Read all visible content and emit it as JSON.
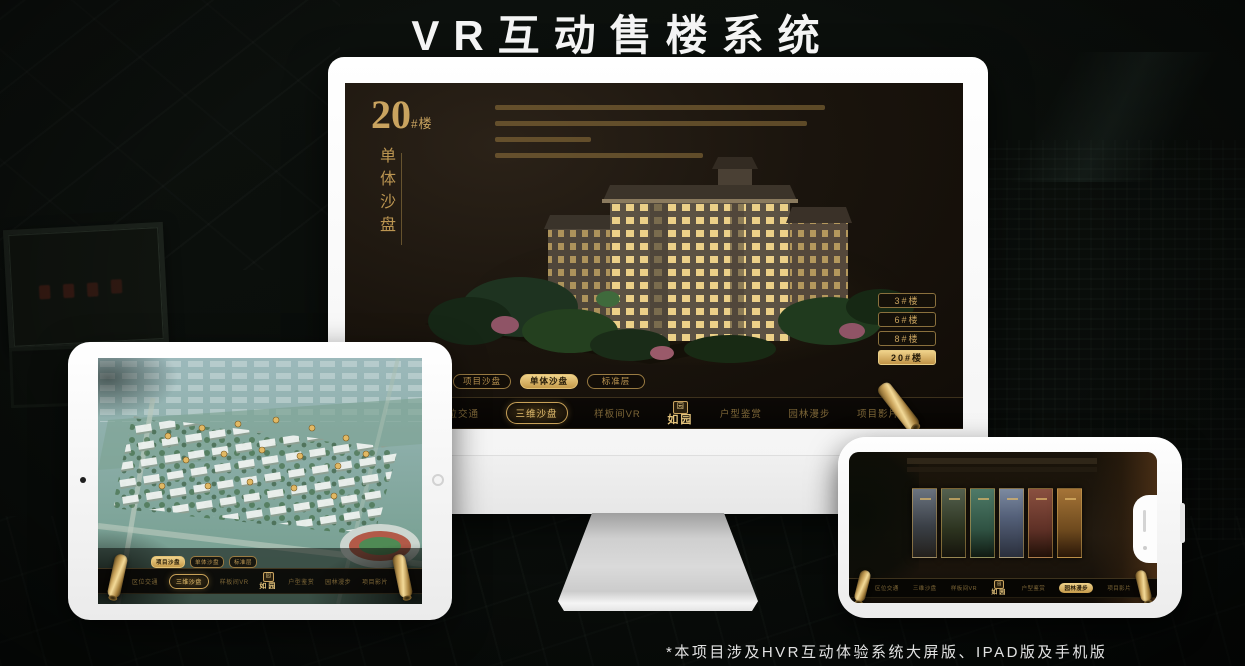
{
  "title": "VR互动售楼系统",
  "footnote": "*本项目涉及HVR互动体验系统大屏版、IPAD版及手机版",
  "brand": {
    "logo_text": "如园",
    "logo_seal": "园"
  },
  "nav_items": [
    {
      "label": "区位交通"
    },
    {
      "label": "三维沙盘"
    },
    {
      "label": "样板间VR"
    },
    {
      "label": "户型鉴赏"
    },
    {
      "label": "园林漫步"
    },
    {
      "label": "项目影片"
    }
  ],
  "sub_tabs": [
    {
      "label": "项目沙盘"
    },
    {
      "label": "单体沙盘"
    },
    {
      "label": "标准层"
    }
  ],
  "monitor_screen": {
    "building_number": "20",
    "building_number_suffix": "#楼",
    "panel_title_vertical": "单体沙盘",
    "floor_buttons": [
      {
        "label": "3#楼"
      },
      {
        "label": "6#楼"
      },
      {
        "label": "8#楼"
      },
      {
        "label": "20#楼"
      }
    ]
  },
  "colors": {
    "gold": "#c9a35f",
    "gold_bright": "#ecd088",
    "gold_dim": "#7d6637",
    "screen_bg": "#17120c",
    "nav_bg": "#0a0805",
    "active_text": "#241a08"
  }
}
